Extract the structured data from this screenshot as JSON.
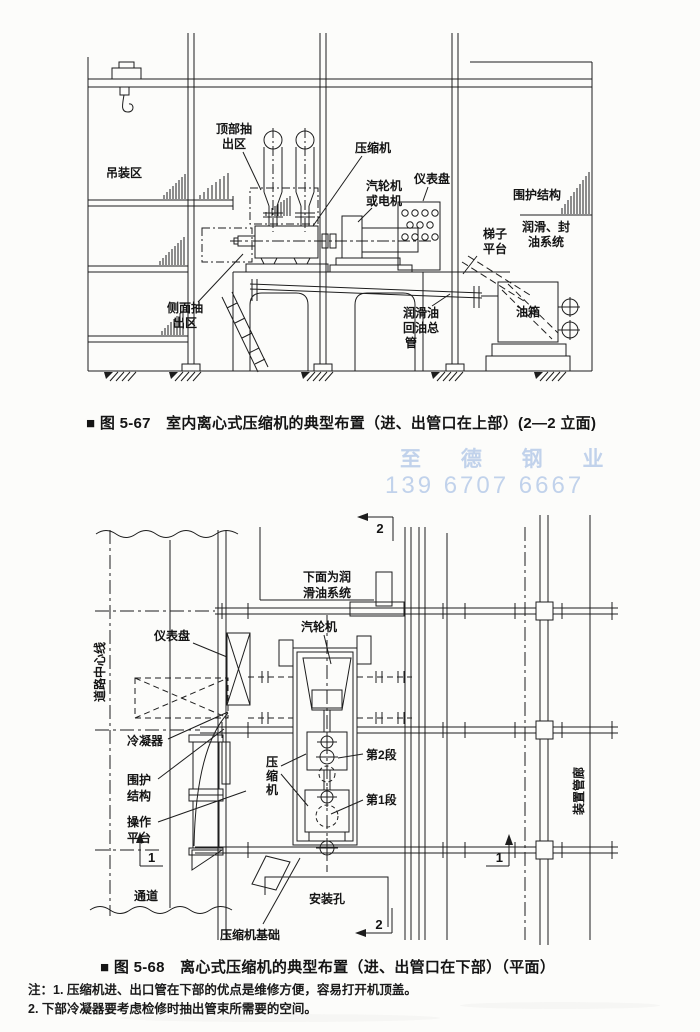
{
  "fig1": {
    "caption": "■ 图 5-67　室内离心式压缩机的典型布置（进、出管口在上部）(2—2 立面)",
    "labels": {
      "lifting_area": "吊装区",
      "top_extraction": [
        "顶部抽",
        "出区"
      ],
      "compressor": "压缩机",
      "turbine_or_motor": [
        "汽轮机",
        "或电机"
      ],
      "instrument_panel": "仪表盘",
      "enclosure": "围护结构",
      "lube_seal_system": [
        "润滑、封",
        "油系统"
      ],
      "ladder_platform": [
        "梯子",
        "平台"
      ],
      "oil_tank": "油箱",
      "side_extraction": [
        "侧面抽",
        "出区"
      ],
      "oil_return_header": [
        "润滑油",
        "回油总",
        "管"
      ]
    }
  },
  "fig2": {
    "caption": "■ 图 5-68　离心式压缩机的典型布置（进、出管口在下部）（平面）",
    "labels": {
      "lube_system_below": [
        "下面为润",
        "滑油系统"
      ],
      "instrument_panel": "仪表盘",
      "steam_turbine": "汽轮机",
      "road_centerline": "道路中心线",
      "condenser": "冷凝器",
      "enclosure": [
        "围护",
        "结构"
      ],
      "compressor": [
        "压",
        "缩",
        "机"
      ],
      "stage2": "第2段",
      "stage1": "第1段",
      "operating_platform": [
        "操作",
        "平台"
      ],
      "passage": "通道",
      "installation_hole": "安装孔",
      "compressor_foundation": "压缩机基础",
      "pipe_gallery": "装置管廊",
      "section_marker_1": "1",
      "section_marker_2": "2"
    }
  },
  "watermark": {
    "line1": "至 德 钢 业",
    "line2": "139 6707 6667",
    "color": "#b7cbe9"
  },
  "notes": {
    "line1": "注：1. 压缩机进、出口管在下部的优点是维修方便，容易打开机顶盖。",
    "line2": "2. 下部冷凝器要考虑检修时抽出管束所需要的空间。"
  },
  "ink_color": "#1d1d1d"
}
